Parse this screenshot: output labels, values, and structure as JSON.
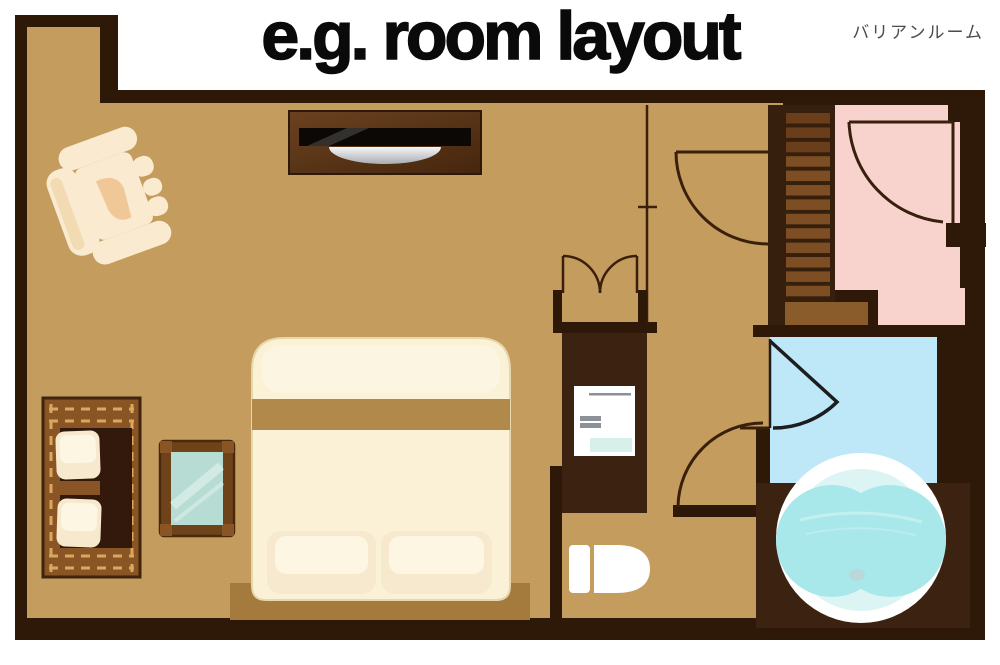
{
  "title": "e.g. room layout",
  "room_label": "バリアンルーム",
  "diagram": {
    "type": "floor-plan",
    "furniture": [
      "massage-chair",
      "tv-console",
      "double-bed",
      "pillows",
      "wooden-bench-sofa",
      "mirror",
      "closet-folding-door",
      "vanity-basin",
      "toilet",
      "staircase",
      "entry-hall",
      "shower-room",
      "round-bathtub",
      "hinged-doors"
    ]
  },
  "palette": {
    "wall": "#2e1909",
    "wallWarm": "#3c2210",
    "floor": "#c49c5e",
    "entry": "#f8d3cd",
    "bath": "#bee8f7",
    "water": "#a9e8ea",
    "tubRim": "#ffffff",
    "tubInner": "#dcf4f4",
    "landing": "#8a5c2c",
    "step": "#7d4e24",
    "stepDark": "#6a3e1b",
    "stairBase": "#36200d",
    "doorLine": "#3a1f0b",
    "doorDark": "#1c1d1f",
    "wood": "#8a5524",
    "woodDash": "#d9a75e",
    "woodInterior": "#33190c",
    "cream": "#fbf1d6",
    "creamLight": "#fdf6e3",
    "band": "#b1894a",
    "headboard": "#a57b3d",
    "pillow": "#f6e9cd",
    "cabinetLight": "#6b4220",
    "cabinetDark": "#45260e",
    "tvBlack": "#0b0806",
    "tvGloss": "#3a3835",
    "silverLight": "#f5f6f7",
    "silverDark": "#a9adb2",
    "glass": "#b7dcd4",
    "glassStreak": "#e9f6f0",
    "mirrorFrame": "#6f4319",
    "grayBar": "#8b9196",
    "aquaStrip": "#d8f0ea",
    "white": "#ffffff",
    "chairCream": "#f9ead0",
    "chairShade": "#f0d4a6",
    "chairPatch": "#f0c897",
    "drain": "#b9d8d8",
    "title": "#0a0a0a",
    "label": "#4b4b4b"
  }
}
